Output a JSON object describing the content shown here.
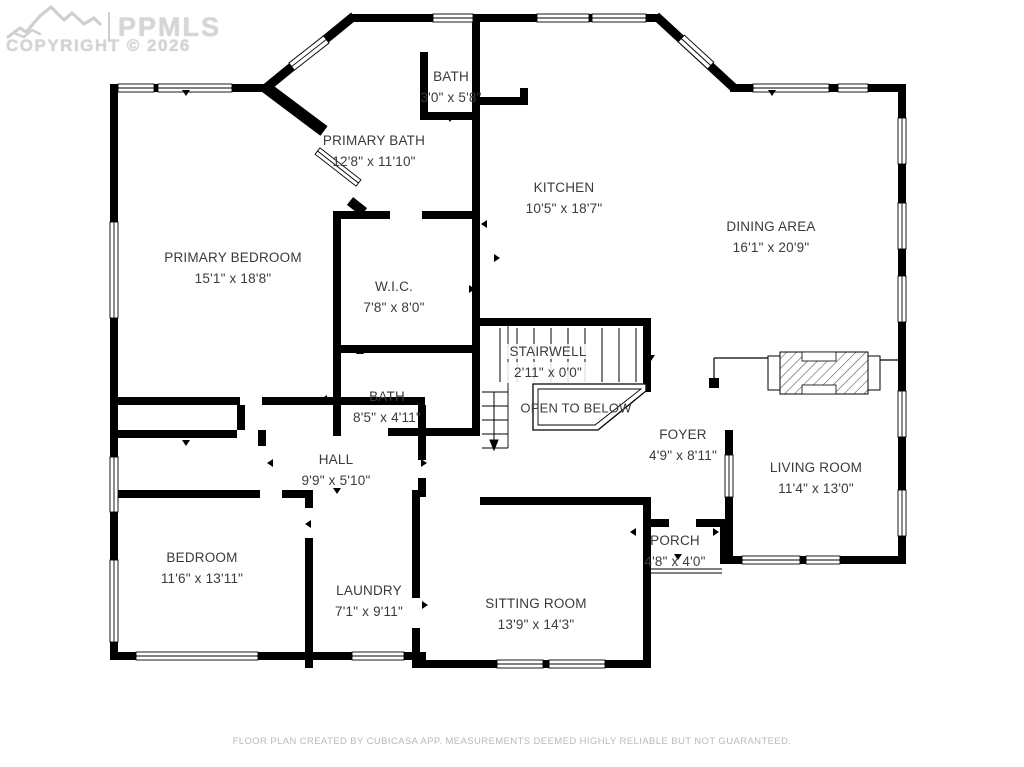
{
  "watermark": {
    "brand": "PPMLS",
    "copyright": "COPYRIGHT © 2026"
  },
  "rooms": {
    "bath_top": {
      "name": "BATH",
      "dims": "3'0\" x 5'8\""
    },
    "primary_bath": {
      "name": "PRIMARY BATH",
      "dims": "12'8\" x 11'10\""
    },
    "kitchen": {
      "name": "KITCHEN",
      "dims": "10'5\" x 18'7\""
    },
    "dining_area": {
      "name": "DINING AREA",
      "dims": "16'1\" x 20'9\""
    },
    "primary_bedroom": {
      "name": "PRIMARY BEDROOM",
      "dims": "15'1\" x 18'8\""
    },
    "wic": {
      "name": "W.I.C.",
      "dims": "7'8\" x 8'0\""
    },
    "stairwell": {
      "name": "STAIRWELL",
      "dims": "2'11\" x 0'0\""
    },
    "open_to_below": {
      "name": "OPEN TO BELOW"
    },
    "bath_hall": {
      "name": "BATH",
      "dims": "8'5\" x 4'11\""
    },
    "foyer": {
      "name": "FOYER",
      "dims": "4'9\" x 8'11\""
    },
    "living_room": {
      "name": "LIVING ROOM",
      "dims": "11'4\" x 13'0\""
    },
    "hall": {
      "name": "HALL",
      "dims": "9'9\" x 5'10\""
    },
    "bedroom": {
      "name": "BEDROOM",
      "dims": "11'6\" x 13'11\""
    },
    "laundry": {
      "name": "LAUNDRY",
      "dims": "7'1\" x 9'11\""
    },
    "sitting_room": {
      "name": "SITTING ROOM",
      "dims": "13'9\" x 14'3\""
    },
    "porch": {
      "name": "PORCH",
      "dims": "4'8\" x 4'0\""
    }
  },
  "footer": {
    "disclaimer": "FLOOR PLAN CREATED BY CUBICASA APP. MEASUREMENTS DEEMED HIGHLY RELIABLE BUT NOT GUARANTEED."
  },
  "colors": {
    "wall": "#000000",
    "label_text": "#3a3a3a",
    "watermark": "#d0d0d0",
    "disclaimer": "#b9b9b9",
    "background": "#ffffff"
  }
}
